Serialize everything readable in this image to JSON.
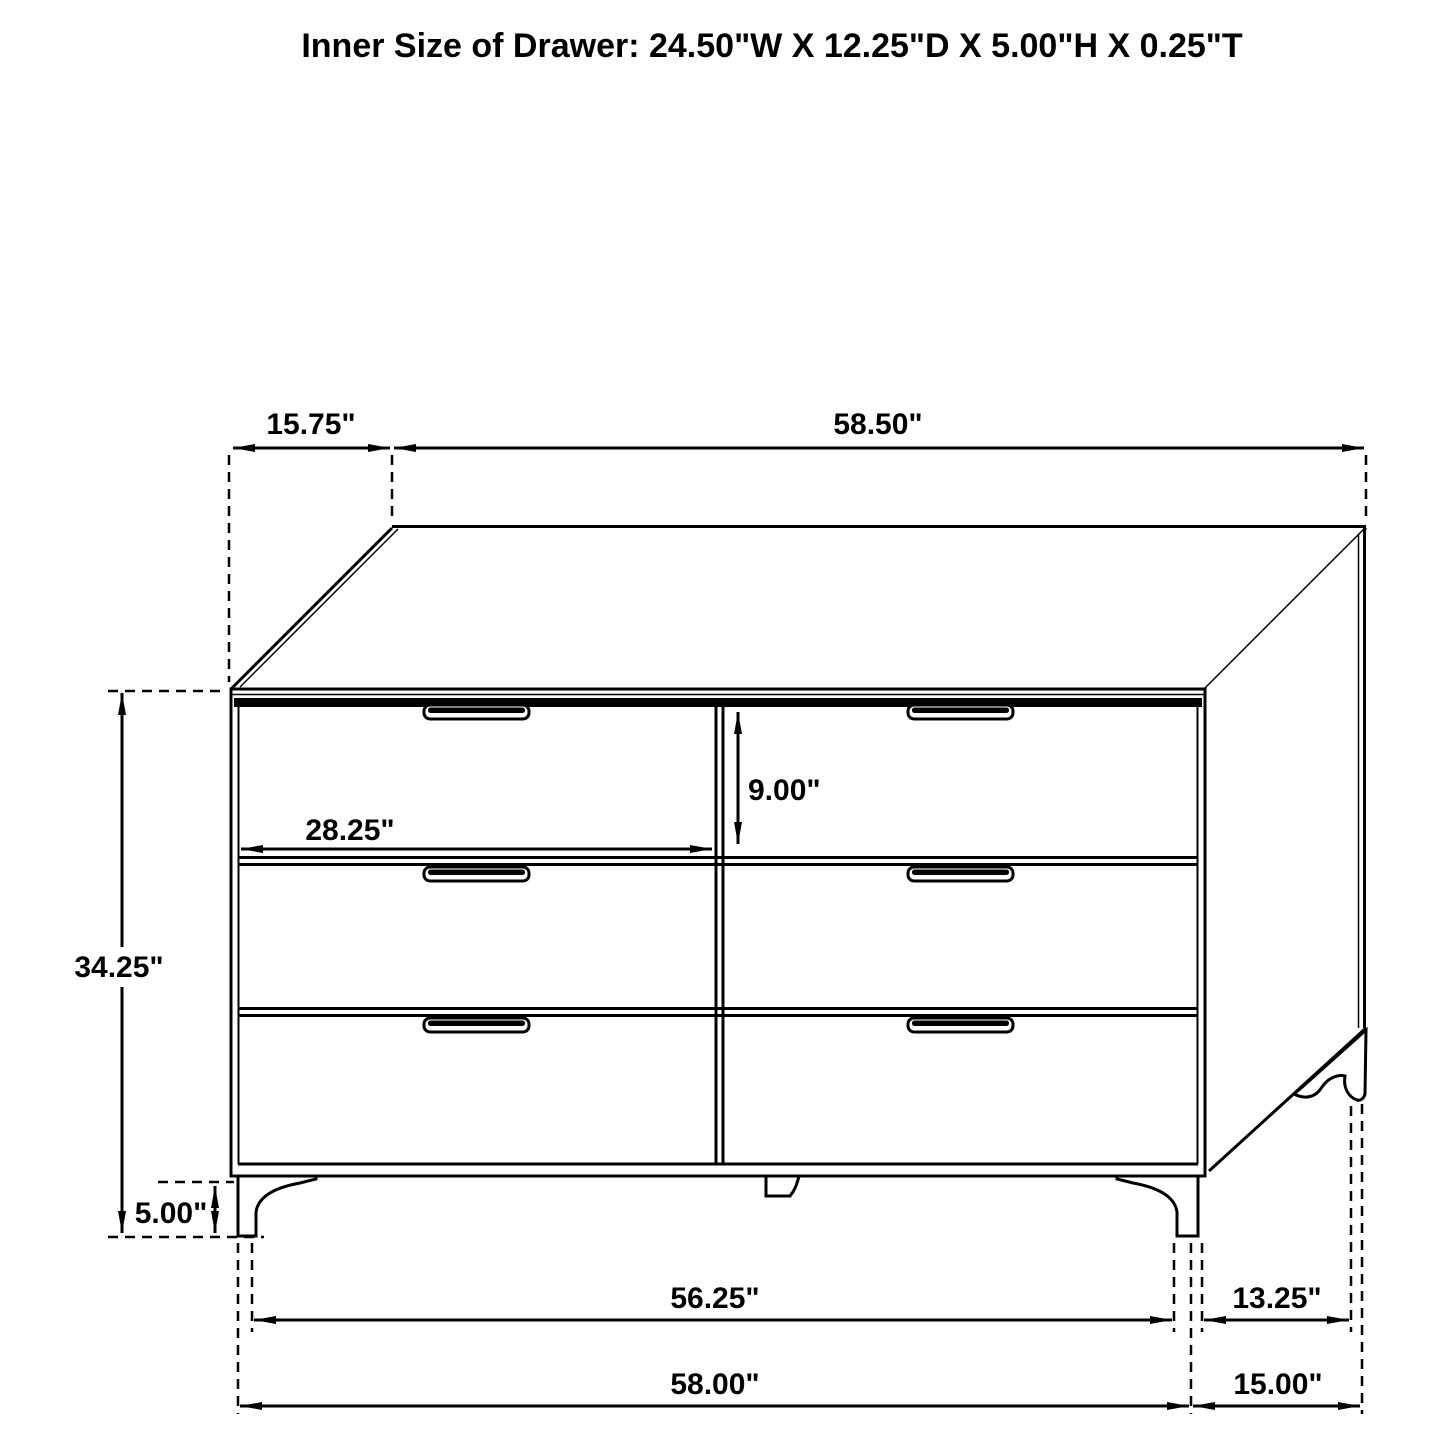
{
  "title": "Inner Size of Drawer: 24.50\"W X 12.25\"D X 5.00\"H X 0.25\"T",
  "colors": {
    "line": "#000000",
    "background": "#ffffff"
  },
  "dims": {
    "top_depth": "15.75\"",
    "top_width": "58.50\"",
    "overall_height": "34.25\"",
    "drawer_width": "28.25\"",
    "drawer_height": "9.00\"",
    "leg_height": "5.00\"",
    "base_inner_width": "56.25\"",
    "base_overall_width": "58.00\"",
    "base_inner_depth": "13.25\"",
    "base_overall_depth": "15.00\""
  }
}
